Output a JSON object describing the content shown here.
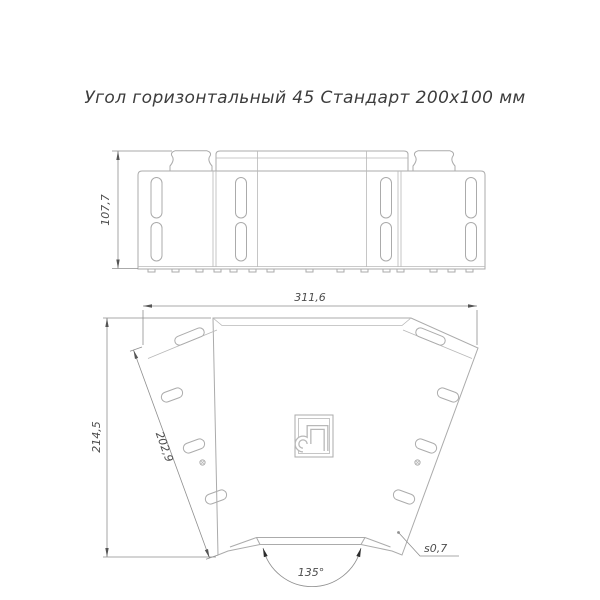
{
  "title": "Угол горизонтальный 45 Стандарт 200x100 мм",
  "front_view": {
    "height": "107,7"
  },
  "plan_view": {
    "width": "311,6",
    "height": "214,5",
    "end_width": "202,9",
    "angle": "135°",
    "thickness": "s0,7"
  },
  "icons": {
    "logo": "promrukav-logo"
  },
  "colors": {
    "part_line": "#ababab",
    "dim_line": "#8f8f8f",
    "dim_text": "#4d4d4d",
    "title_text": "#3c3c3c",
    "background": "#ffffff"
  }
}
